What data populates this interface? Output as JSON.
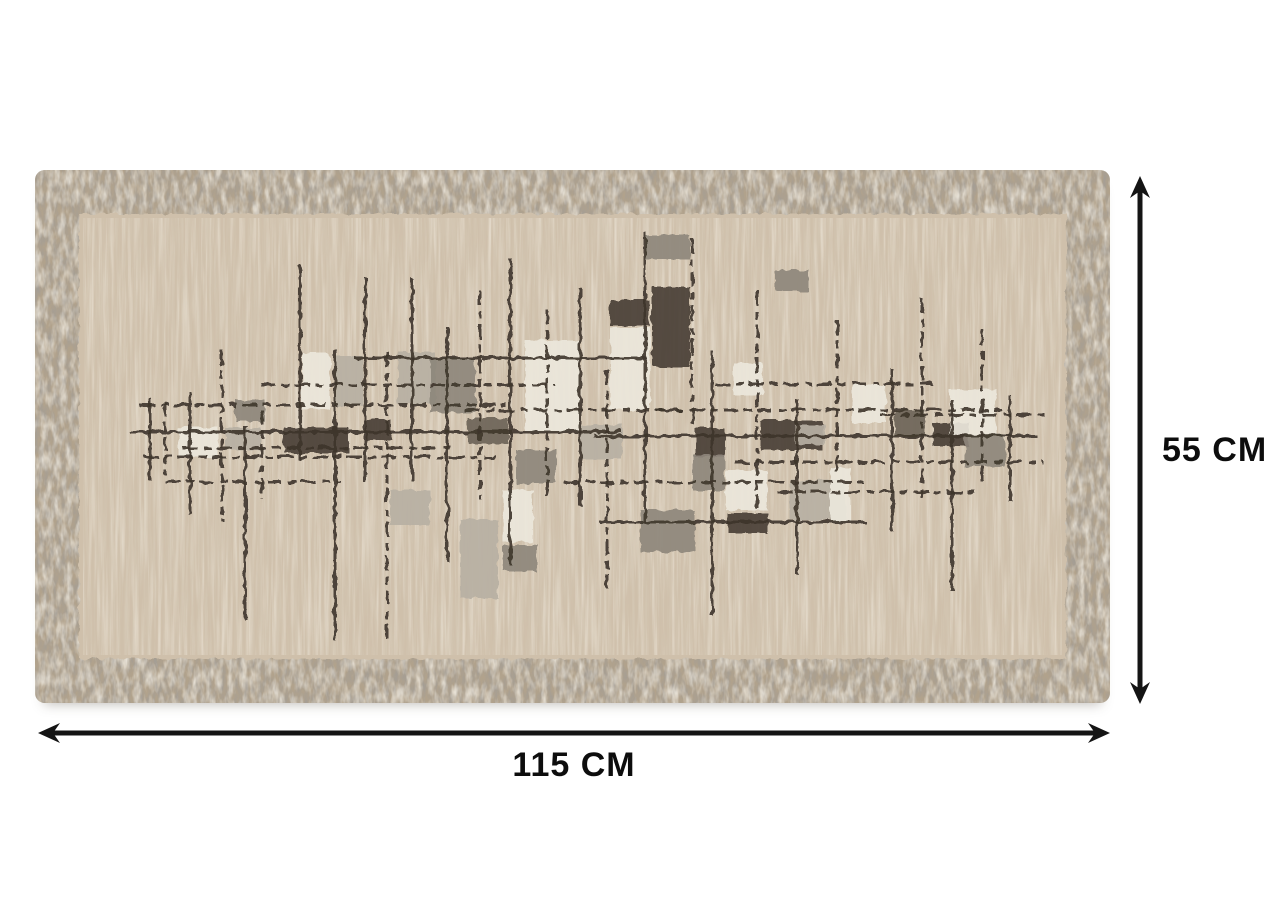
{
  "annotations": {
    "width_label": "115 CM",
    "height_label": "55 CM",
    "arrow_color": "#141414",
    "label_color": "#0d0d0d"
  },
  "rug": {
    "width_px": 1075,
    "height_px": 533,
    "border": {
      "base": "#b1a28c",
      "speckle_dark": "#5f574c",
      "speckle_light": "#e8ddcb",
      "thickness_px": 44
    },
    "field": {
      "base": "#cfc0ab",
      "streak_dark": "#b3a289",
      "streak_light": "#efe7d6"
    },
    "palette": {
      "line": "#3e362c",
      "white": "#ece7db",
      "lightgray": "#b7b0a3",
      "gray": "#8e877c",
      "darkgray": "#6c6459",
      "dark": "#4a4136"
    },
    "pattern": {
      "rects": [
        [
          143,
          257,
          40,
          30,
          "white"
        ],
        [
          190,
          258,
          36,
          22,
          "lightgray"
        ],
        [
          248,
          257,
          66,
          26,
          "dark"
        ],
        [
          200,
          230,
          30,
          22,
          "gray"
        ],
        [
          267,
          183,
          28,
          56,
          "white"
        ],
        [
          300,
          186,
          28,
          50,
          "lightgray"
        ],
        [
          363,
          182,
          38,
          52,
          "lightgray"
        ],
        [
          395,
          188,
          45,
          55,
          "gray"
        ],
        [
          330,
          250,
          26,
          20,
          "dark"
        ],
        [
          433,
          248,
          40,
          26,
          "darkgray"
        ],
        [
          490,
          170,
          55,
          92,
          "white"
        ],
        [
          481,
          280,
          40,
          34,
          "gray"
        ],
        [
          355,
          320,
          40,
          35,
          "lightgray"
        ],
        [
          425,
          350,
          38,
          78,
          "lightgray"
        ],
        [
          468,
          320,
          30,
          52,
          "white"
        ],
        [
          468,
          375,
          34,
          26,
          "gray"
        ],
        [
          545,
          255,
          42,
          34,
          "lightgray"
        ],
        [
          575,
          130,
          40,
          26,
          "dark"
        ],
        [
          575,
          158,
          40,
          82,
          "white"
        ],
        [
          617,
          117,
          38,
          80,
          "dark"
        ],
        [
          610,
          65,
          45,
          24,
          "gray"
        ],
        [
          660,
          257,
          30,
          30,
          "dark"
        ],
        [
          658,
          285,
          32,
          36,
          "gray"
        ],
        [
          698,
          193,
          30,
          32,
          "white"
        ],
        [
          691,
          300,
          42,
          40,
          "white"
        ],
        [
          693,
          343,
          40,
          20,
          "dark"
        ],
        [
          605,
          340,
          55,
          42,
          "gray"
        ],
        [
          726,
          250,
          62,
          30,
          "dark"
        ],
        [
          760,
          255,
          30,
          20,
          "lightgray"
        ],
        [
          755,
          310,
          55,
          40,
          "lightgray"
        ],
        [
          740,
          100,
          34,
          22,
          "gray"
        ],
        [
          817,
          215,
          34,
          38,
          "white"
        ],
        [
          795,
          298,
          20,
          54,
          "white"
        ],
        [
          860,
          240,
          30,
          26,
          "darkgray"
        ],
        [
          898,
          253,
          36,
          24,
          "dark"
        ],
        [
          915,
          220,
          46,
          44,
          "white"
        ],
        [
          930,
          264,
          40,
          32,
          "gray"
        ]
      ],
      "h_lines": [
        [
          105,
          235,
          470,
          1
        ],
        [
          95,
          262,
          585,
          0
        ],
        [
          108,
          287,
          460,
          1
        ],
        [
          130,
          312,
          305,
          1
        ],
        [
          148,
          278,
          420,
          1
        ],
        [
          225,
          215,
          520,
          1
        ],
        [
          320,
          188,
          612,
          0
        ],
        [
          430,
          240,
          648,
          1
        ],
        [
          530,
          312,
          830,
          1
        ],
        [
          558,
          266,
          1002,
          0
        ],
        [
          620,
          240,
          966,
          1
        ],
        [
          680,
          214,
          902,
          1
        ],
        [
          700,
          292,
          1008,
          1
        ],
        [
          742,
          322,
          940,
          1
        ],
        [
          565,
          352,
          832,
          0
        ],
        [
          845,
          245,
          1010,
          1
        ]
      ],
      "v_lines": [
        [
          115,
          228,
          310,
          0
        ],
        [
          130,
          232,
          305,
          1
        ],
        [
          155,
          222,
          345,
          0
        ],
        [
          187,
          180,
          352,
          1
        ],
        [
          210,
          255,
          450,
          0
        ],
        [
          227,
          240,
          330,
          1
        ],
        [
          265,
          95,
          290,
          0
        ],
        [
          300,
          180,
          470,
          0
        ],
        [
          330,
          108,
          312,
          0
        ],
        [
          352,
          182,
          470,
          1
        ],
        [
          377,
          108,
          312,
          0
        ],
        [
          412,
          158,
          392,
          0
        ],
        [
          445,
          120,
          330,
          1
        ],
        [
          475,
          88,
          395,
          0
        ],
        [
          512,
          140,
          330,
          1
        ],
        [
          545,
          118,
          336,
          0
        ],
        [
          572,
          200,
          425,
          1
        ],
        [
          610,
          62,
          352,
          0
        ],
        [
          657,
          68,
          255,
          1
        ],
        [
          677,
          180,
          445,
          0
        ],
        [
          722,
          120,
          345,
          1
        ],
        [
          762,
          228,
          405,
          0
        ],
        [
          802,
          150,
          302,
          1
        ],
        [
          857,
          198,
          362,
          0
        ],
        [
          887,
          128,
          332,
          1
        ],
        [
          917,
          230,
          422,
          0
        ],
        [
          947,
          160,
          312,
          1
        ],
        [
          975,
          225,
          332,
          0
        ]
      ]
    }
  }
}
